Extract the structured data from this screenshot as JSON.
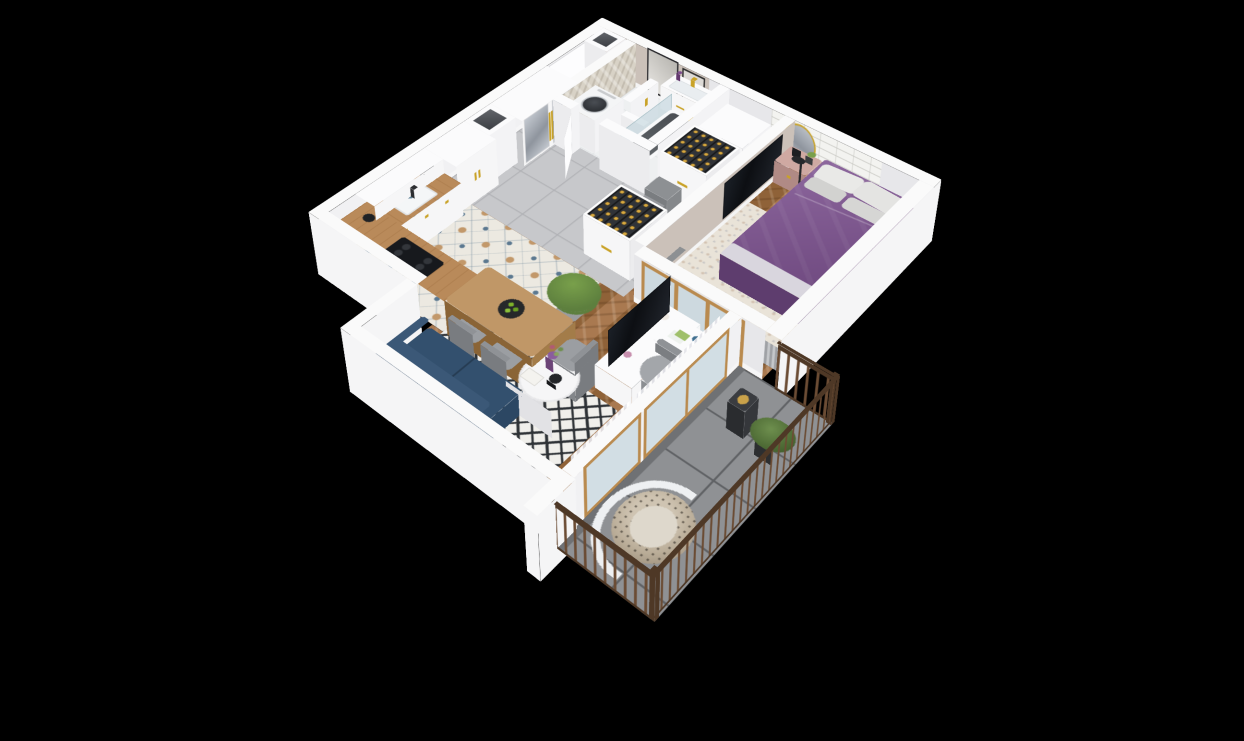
{
  "title": "3D apartment floor plan render",
  "scene": {
    "style": "isometric cutaway 3d floor plan on black background",
    "visible_text": "none"
  },
  "colors": {
    "background": "#000000",
    "wall-top": "#fafafa",
    "wall-front": "#e7e7ea",
    "wall-side": "#f1f1f3",
    "wall-outer": "#f5f5f6",
    "greige": "#cbc1b9",
    "subway": "#f3f3f0",
    "herringbone-wall": "#d8d2c6",
    "wood-floor": "#a97950",
    "wood-floor-dark": "#8f6238",
    "hall-tile": "#c7c8cb",
    "hall-tile-line": "#b0b1b5",
    "kitchen-tile-base": "#ece9e1",
    "kitchen-tile-blue": "#5b7890",
    "kitchen-tile-tan": "#c2986a",
    "bath-floor": "#eef0f1",
    "balcony-tile": "#8f9194",
    "balcony-grout": "#606265",
    "railing-wood": "#6b4c34",
    "railing-dark": "#4e3826",
    "bed-purple": "#7d5290",
    "bed-purple-dark": "#5e3d6e",
    "bed-purple-side": "#6b4477",
    "bed-fold": "#d9d6de",
    "pillow-white": "#e9e9e7",
    "pillow-gray": "#d2d2d0",
    "rug-bedroom": "#e9e3d8",
    "rug-living-base": "#f0efeb",
    "rug-living-pattern": "#2e3236",
    "sofa-navy": "#33506e",
    "sofa-navy-dark": "#27405c",
    "wood-counter": "#b98a5a",
    "wood-table": "#c09767",
    "cabinet-white": "#f6f6f7",
    "gold": "#c9a227",
    "mirror-a": "#c3c8cf",
    "mirror-b": "#8f959e",
    "tv-dark": "#14171c",
    "chair-gray": "#9b9ea2",
    "nightstand-pink": "#c7a09a",
    "plant-green": "#5d7f3e",
    "plant-green-light": "#79a04b",
    "rattan": "#b9ac97",
    "lantern-dark": "#2a2c2f",
    "glass-blue": "rgba(173,200,210,0.45)",
    "washer-drum": "#2e3135",
    "oak-frame": "#b98a4e",
    "bottle-rack": "#303338"
  },
  "rooms": [
    {
      "name": "hallway",
      "floor": "gray ceramic tiles",
      "items": [
        "entrance-door",
        "mirror-wardrobe",
        "duct-column",
        "white-wardrobe",
        "shoes"
      ]
    },
    {
      "name": "bathroom",
      "floor": "light tiles",
      "items": [
        "washing-machine",
        "toilet",
        "half-wall",
        "vanity-sink",
        "round-gold-mirror",
        "bathtub",
        "glass-screen",
        "towel-bar"
      ]
    },
    {
      "name": "kitchen",
      "floor": "patterned encaustic tiles",
      "items": [
        "l-shaped-counter",
        "sink",
        "cooktop",
        "upper-cabinets",
        "coffee-maker",
        "dining-table",
        "fruit-plate",
        "chairs",
        "stool",
        "potted-plant"
      ]
    },
    {
      "name": "living-room",
      "floor": "herringbone wood",
      "items": [
        "navy-sofa",
        "bw-diamond-rug",
        "round-coffee-table",
        "flower-vase",
        "tv-sideboard",
        "television",
        "curtains",
        "desk",
        "office-chair",
        "bottle-cabinets",
        "storage-bins",
        "drawer-unit"
      ]
    },
    {
      "name": "bedroom",
      "floor": "herringbone wood",
      "items": [
        "double-bed-purple",
        "pillows",
        "pink-nightstand",
        "floor-lamp",
        "wall-frames",
        "wall-tv",
        "beige-rug",
        "radiator"
      ]
    },
    {
      "name": "balcony",
      "floor": "concrete tiles",
      "items": [
        "wood-slat-railing",
        "hanging-egg-chair",
        "lantern",
        "potted-plant",
        "glazed-doors"
      ]
    }
  ]
}
